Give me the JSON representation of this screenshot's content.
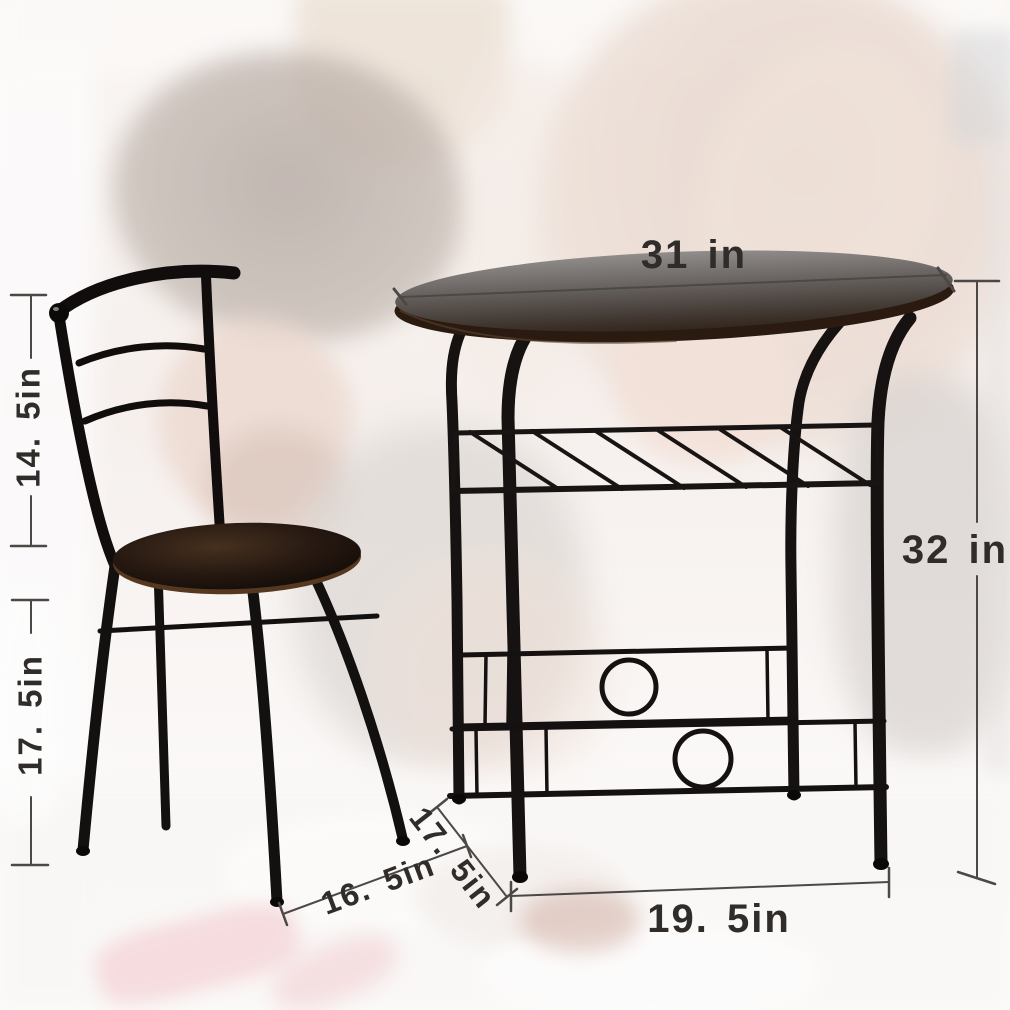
{
  "product_dimensions": {
    "table_top_width": "31 in",
    "table_height": "32 in",
    "table_base_width": "19. 5in",
    "table_depth": "17. 5in",
    "chair_back_height": "14. 5in",
    "chair_seat_height": "17. 5in",
    "chair_seat_width": "16. 5in"
  },
  "colors": {
    "metal_frame": "#141110",
    "table_top_surface": "#6b6663",
    "wood_edge": "#2a1a10",
    "seat_wood": "#241710",
    "dimension_line": "#4c4846",
    "dimension_text": "#2f2c2a",
    "background_tint": "#f2e9e5",
    "napkin_pink": "#efb3ba"
  }
}
